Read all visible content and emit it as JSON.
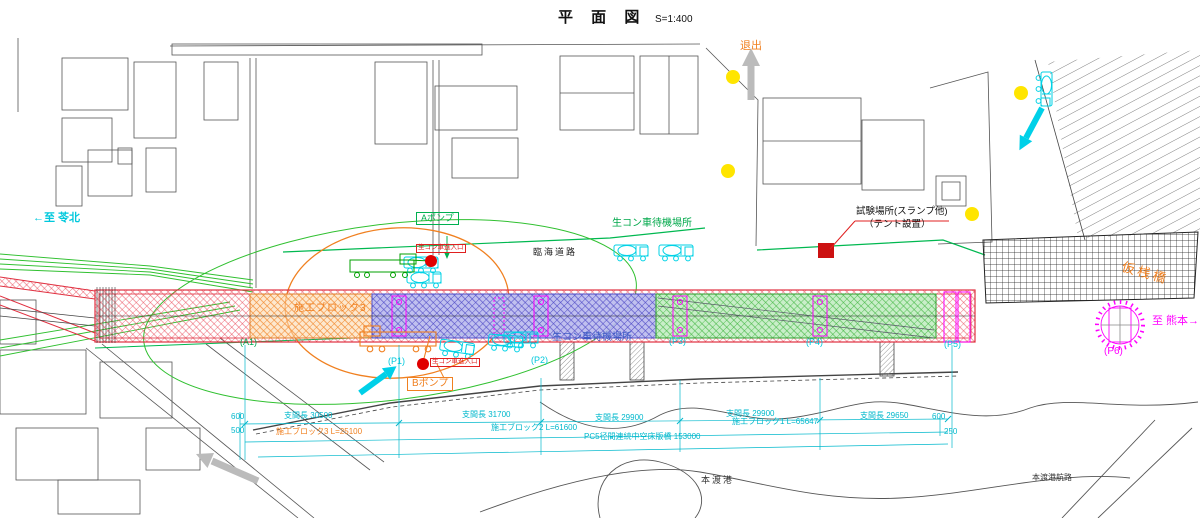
{
  "title": {
    "main": "平 面 図",
    "scale": "S=1:400"
  },
  "annotations": {
    "exit": "退出",
    "to_reihoku": "←至 苓北",
    "to_kumamoto": "至 熊本→",
    "temp_trestle": "仮桟橋",
    "coastal_road": "臨海道路",
    "waiting_area_top": "生コン車待機場所",
    "waiting_area_bottom": "生コン車待機場所",
    "pump_a": "Aポンプ",
    "pump_b": "Bポンプ",
    "truck_entry_top": "生コン車進入口",
    "truck_entry_bottom": "生コン車進入口",
    "test_site": "試験場所(スランプ他)",
    "tent": "（テント設置）",
    "block3_zone": "施工ブロック3",
    "hondo_port": "本渡港",
    "hondo_route": "本渡港航路"
  },
  "piers": {
    "a1": "(A1)",
    "p1": "(P1)",
    "p2": "(P2)",
    "p3": "(P3)",
    "p4": "(P4)",
    "p5": "(P5)",
    "p6": "(P6)"
  },
  "dimensions": {
    "edge_left_top": "600",
    "edge_left_bottom": "500",
    "span_1": "支間長 30500",
    "span_2": "支間長 31700",
    "span_3": "支間長 29900",
    "span_4": "支間長 29900",
    "span_5": "支間長 29650",
    "edge_right_top": "600",
    "edge_right_bottom": "250",
    "block_3": "施工ブロック3 L=25100",
    "block_2": "施工ブロック2 L=61600",
    "block_1": "施工ブロック1 L=65647",
    "total": "PC5径間連続中空床版橋 153000"
  },
  "colors": {
    "bridge_red": "#e03040",
    "orange": "#f08020",
    "green": "#00a84a",
    "cyan": "#00c8dc",
    "magenta": "#ff00ff",
    "yellow": "#ffe500",
    "blue_block": "#5050c8",
    "dim_text": "#00b8cc",
    "gray_arrow": "#bbbbbb"
  }
}
